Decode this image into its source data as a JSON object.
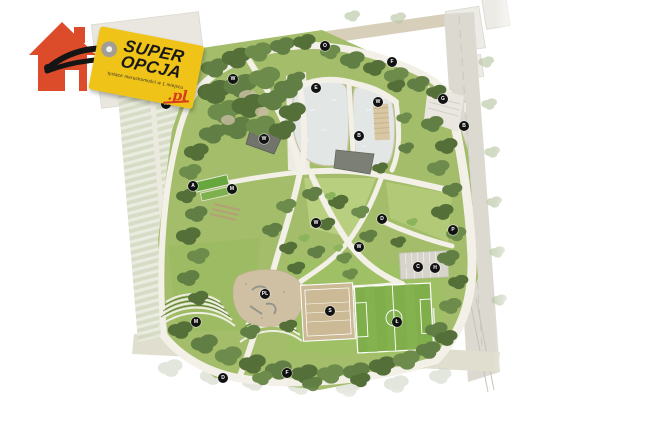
{
  "page": {
    "background_color": "#ffffff"
  },
  "logo": {
    "brand_top": "SUPER",
    "brand_bottom": "OPCJA",
    "domain_suffix": ".pl",
    "tagline": "tysiące nieruchomości w 1 miejscu",
    "tag_color": "#f0c319",
    "house_color": "#dc4b2a",
    "suffix_color": "#d63a1f",
    "string_color": "#151515"
  },
  "map": {
    "kind": "park-master-plan",
    "features": [
      "pond",
      "boardwalk-deck",
      "football-pitch",
      "volleyball-court",
      "playground",
      "community-garden-beds",
      "terraced-seating",
      "parking-lot",
      "tree-canopy",
      "path-network",
      "allotment-fields",
      "street",
      "entrance-plaza"
    ],
    "colors": {
      "lawn": "#a4bd6b",
      "lawn_bright": "#b7cf7e",
      "canopy": "#546f38",
      "path": "#f2f0e7",
      "water": "#e2e7e6",
      "sand": "#cfc0a4",
      "pitch": "#7fae4a",
      "court": "#ccb995",
      "road": "#dcd9d1",
      "road_top": "#d7cfba",
      "marker_bg": "#121212",
      "marker_text": "#ffffff"
    },
    "markers": [
      {
        "label": "O"
      },
      {
        "label": "F"
      },
      {
        "label": "G"
      },
      {
        "label": "B"
      },
      {
        "label": "E"
      },
      {
        "label": "W"
      },
      {
        "label": "B"
      },
      {
        "label": "W"
      },
      {
        "label": "M"
      },
      {
        "label": "W"
      },
      {
        "label": "A"
      },
      {
        "label": "M"
      },
      {
        "label": "W"
      },
      {
        "label": "D"
      },
      {
        "label": "W"
      },
      {
        "label": "P"
      },
      {
        "label": "C"
      },
      {
        "label": "H"
      },
      {
        "label": "S"
      },
      {
        "label": "Ł"
      },
      {
        "label": "PL"
      },
      {
        "label": "M"
      },
      {
        "label": "D"
      },
      {
        "label": "F"
      }
    ]
  }
}
